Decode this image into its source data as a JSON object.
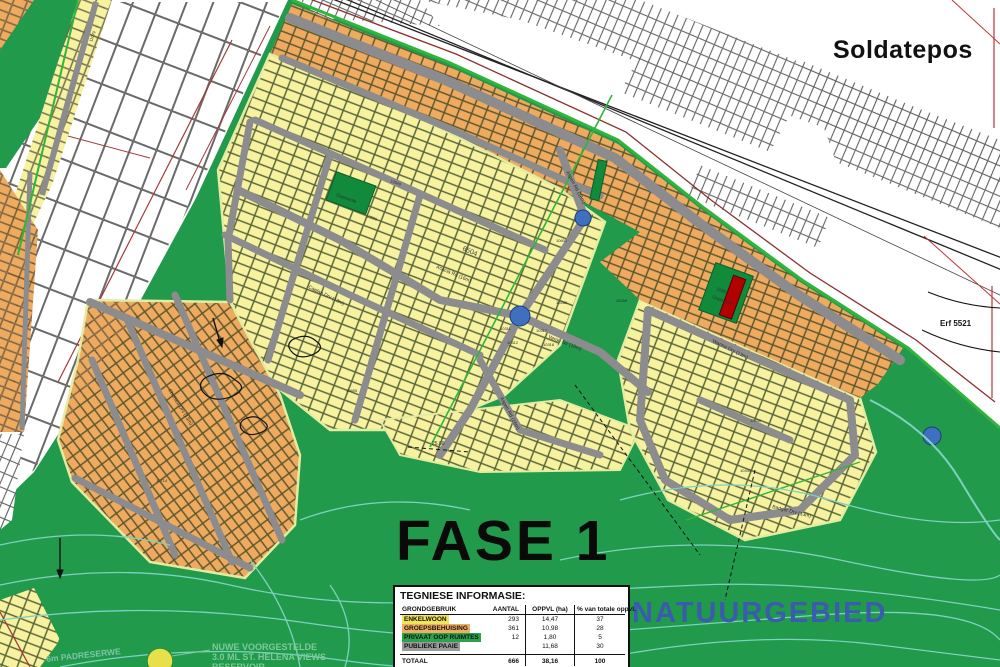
{
  "labels": {
    "soldatepos": "Soldatepos",
    "fase": "FASE 1",
    "natuurgebied": "NATUURGEBIED",
    "erf": "Erf 5521",
    "corridor_number": "6504",
    "dimension": "25.00",
    "reservoir_line1": "NUWE VOORGESTELDE",
    "reservoir_line2": "3.0 ML ST. HELENA VIEWS",
    "reservoir_line3": "RESERVOIR",
    "pad_reserwe": "6m PADRESERWE"
  },
  "open_space": {
    "label": "Oopruimte",
    "erf_number": "10352"
  },
  "streets": [
    {
      "name": "Acacia Rd (16m)"
    },
    {
      "name": "Aspen Rd (16m)"
    },
    {
      "name": "Caelan Drv (13m)"
    },
    {
      "name": "Veron Str (16m)"
    },
    {
      "name": "Chelsea Drv (13m)"
    },
    {
      "name": "Badger Drv (13m)"
    },
    {
      "name": "Wanna Drv (13m)"
    }
  ],
  "plot_numbers": [
    "10311",
    "10312",
    "10317",
    "10318",
    "10286",
    "10540",
    "10586",
    "10601",
    "10655",
    "10714",
    "10430",
    "10444",
    "11079",
    "10269"
  ],
  "table": {
    "title": "TEGNIESE INFORMASIE:",
    "columns": [
      "GRONDGEBRUIK",
      "AANTAL",
      "OPPVL (ha)",
      "% van totale oppvl."
    ],
    "rows": [
      {
        "label": "ENKELWOON",
        "aantal": "293",
        "oppvl": "14,47",
        "pct": "37",
        "color": "#f0e45a"
      },
      {
        "label": "GROEPSBEHUISING",
        "aantal": "361",
        "oppvl": "10,98",
        "pct": "28",
        "color": "#efae62"
      },
      {
        "label": "PRIVAAT OOP RUIMTES",
        "aantal": "12",
        "oppvl": "1,80",
        "pct": "5",
        "color": "#2aa34d"
      },
      {
        "label": "PUBLIEKE PAAIE",
        "aantal": "",
        "oppvl": "11,68",
        "pct": "30",
        "color": "#9b9b9b"
      }
    ],
    "total": {
      "label": "TOTAAL",
      "aantal": "666",
      "oppvl": "38,16",
      "pct": "100"
    }
  },
  "colors": {
    "nature_green": "#219a4b",
    "plot_yellow": "#f7f2a0",
    "plot_orange": "#eeab5f",
    "road_gray": "#8c8c8e",
    "boundary_green": "#2fb53b",
    "open_space_green": "#128a3c",
    "reserved_red": "#b30000",
    "contour_teal": "#7fd0c0",
    "traffic_circle_blue": "#3f6fbf",
    "natuur_text_blue": "#3b5cad"
  }
}
